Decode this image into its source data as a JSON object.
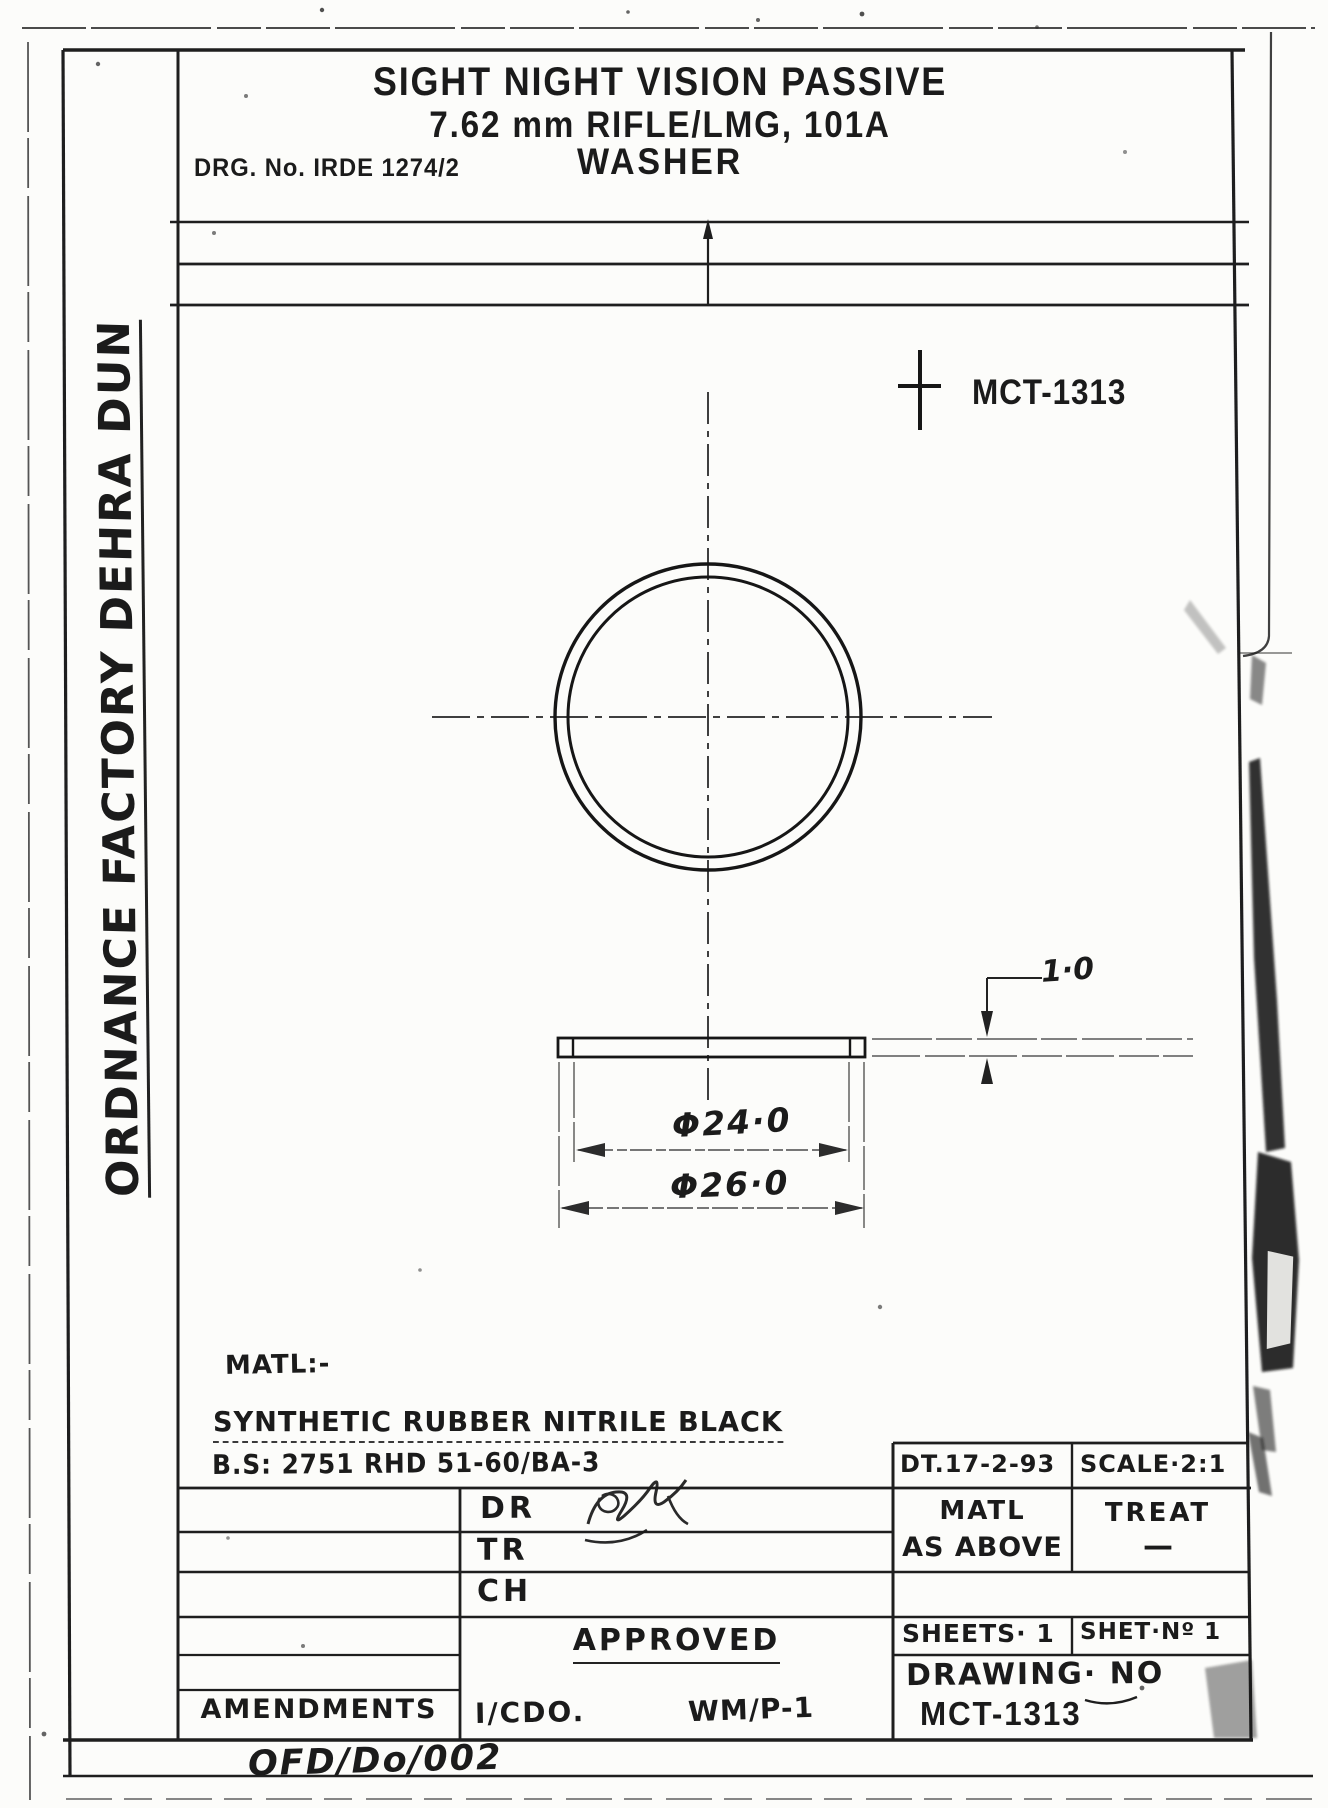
{
  "sheet": {
    "org": "ORDNANCE FACTORY DEHRA DUN",
    "form_no": "OFD/Do/002"
  },
  "header": {
    "title_line1": "SIGHT NIGHT VISION PASSIVE",
    "title_line2": "7.62 mm RIFLE/LMG, 101A",
    "title_line3": "WASHER",
    "drg_no": "DRG. No. IRDE 1274/2",
    "ref_no": "MCT-1313"
  },
  "drawing": {
    "dim_inner_dia": "Φ24·0",
    "dim_outer_dia": "Φ26·0",
    "dim_thickness": "1·0",
    "view_scale_note": "cross-mark"
  },
  "material": {
    "label": "MATL:-",
    "line1": "SYNTHETIC RUBBER NITRILE BLACK",
    "line2": "B.S: 2751 RHD 51-60/BA-3"
  },
  "title_block": {
    "dr_label": "DR",
    "tr_label": "TR",
    "ch_label": "CH",
    "approved_label": "APPROVED",
    "amendments_label": "AMENDMENTS",
    "icdo": "I/CDO.",
    "wmp": "WM/P-1",
    "date": "DT.17-2-93",
    "scale": "SCALE·2:1",
    "matl_label": "MATL",
    "matl_value": "AS ABOVE",
    "treat_label": "TREAT",
    "treat_value": "—",
    "sheets": "SHEETS· 1",
    "sheet_no": "SHET·Nº 1",
    "drawing_no_label": "DRAWING· NO",
    "drawing_no": "MCT-1313"
  },
  "colors": {
    "ink": "#1b1b1b",
    "paper": "#fcfcfa"
  }
}
